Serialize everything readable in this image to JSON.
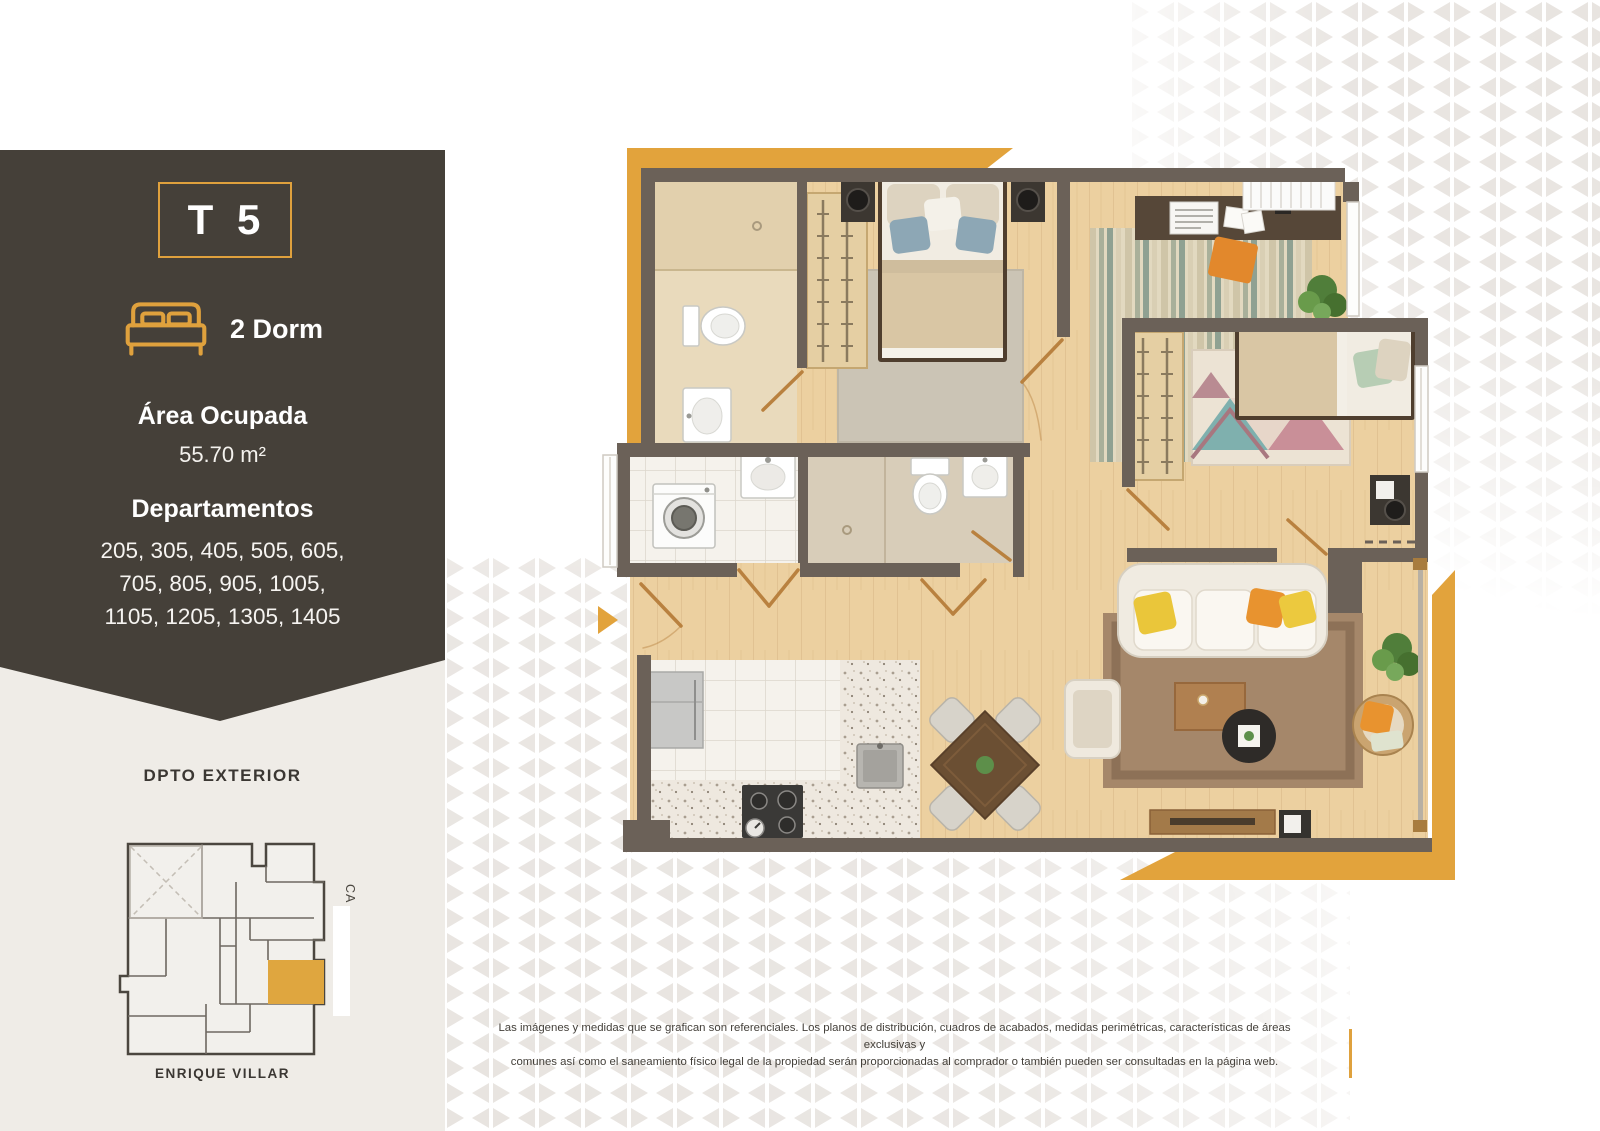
{
  "panel": {
    "type_label": "T 5",
    "bedrooms_label": "2 Dorm",
    "area_title": "Área Ocupada",
    "area_value": "55.70 m²",
    "departments_title": "Departamentos",
    "departments_line1": "205, 305, 405, 505, 605,",
    "departments_line2": "705, 805, 905, 1005,",
    "departments_line3": "1105, 1205, 1305, 1405",
    "bg_color": "#454039",
    "accent_color": "#DFA13D"
  },
  "key_plan": {
    "title": "DPTO EXTERIOR",
    "street_right": "CA",
    "street_bottom": "ENRIQUE VILLAR",
    "highlight_color": "#DFA63F"
  },
  "disclaimer": {
    "line1": "Las imágenes y medidas que se grafican son referenciales. Los planos de distribución, cuadros de acabados, medidas perimétricas, características de áreas exclusivas y",
    "line2": "comunes así como el saneamiento físico legal de la propiedad serán proporcionadas al comprador o también pueden ser consultadas en la página web."
  },
  "floor_plan": {
    "wall_color": "#6B6158",
    "wood_color": "#ECD0A0",
    "accent_color": "#E2A33C"
  },
  "pattern": {
    "triangle_color": "#E8E4E0",
    "background_beige": "#EFECE7"
  }
}
